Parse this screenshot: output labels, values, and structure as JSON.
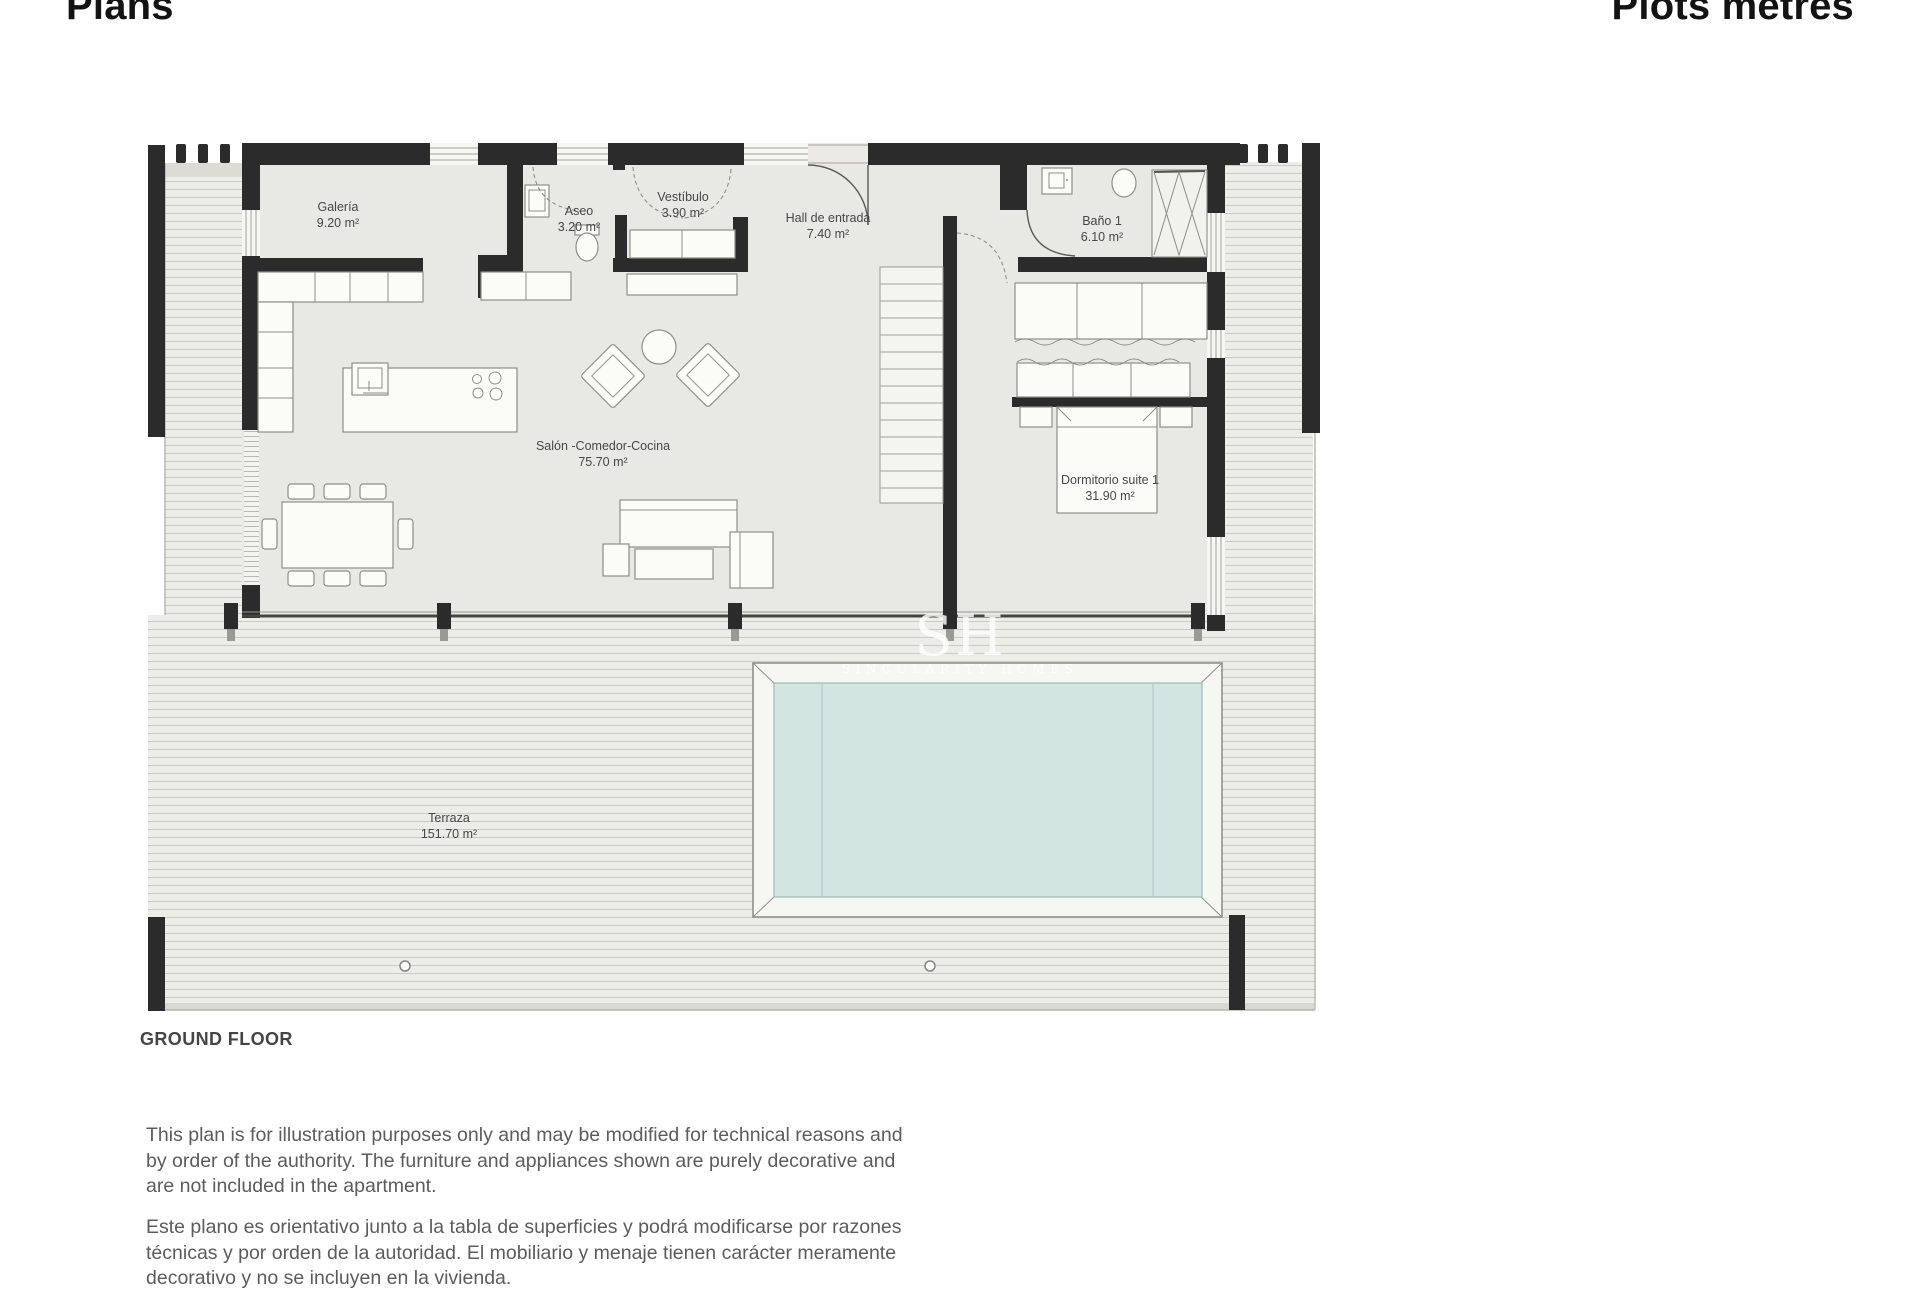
{
  "page": {
    "title_left": "Plans",
    "title_right": "Plots metres",
    "caption": "GROUND FLOOR",
    "disclaimer_en": {
      "lines": [
        "This plan is for illustration purposes only and may be modified for technical reasons and",
        "by order of the authority. The furniture and appliances shown are purely decorative and",
        "are not included in the apartment."
      ]
    },
    "disclaimer_es": {
      "lines": [
        "Este plano es orientativo junto a la tabla de superficies y podrá modificarse por razones",
        "técnicas y por orden de la autoridad. El mobiliario y menaje tienen carácter meramente",
        "decorativo y no se incluyen en la vivienda."
      ]
    }
  },
  "floor_plan": {
    "floor_name": "GROUND FLOOR",
    "rooms": [
      {
        "id": "galeria",
        "name": "Galería",
        "area": "9.20 m²"
      },
      {
        "id": "aseo",
        "name": "Aseo",
        "area": "3.20 m²"
      },
      {
        "id": "vestibulo",
        "name": "Vestíbulo",
        "area": "3.90 m²"
      },
      {
        "id": "hall",
        "name": "Hall de entrada",
        "area": "7.40 m²"
      },
      {
        "id": "bano1",
        "name": "Baño 1",
        "area": "6.10 m²"
      },
      {
        "id": "salon",
        "name": "Salón -Comedor-Cocina",
        "area": "75.70 m²"
      },
      {
        "id": "dormitorio",
        "name": "Dormitorio suite 1",
        "area": "31.90 m²"
      },
      {
        "id": "terraza",
        "name": "Terraza",
        "area": "151.70 m²"
      }
    ],
    "watermark": {
      "initials": "SH",
      "name": "SINGULARITY HOMES"
    },
    "colors": {
      "wall": "#2b2b2b",
      "interior": "#e8e8e5",
      "deck": "#ecece8",
      "deck_line": "#cbcbc3",
      "pool_water": "#d3e5e1",
      "pool_line": "#a9c0bc",
      "furniture_line": "#8f8f89",
      "label": "#474747"
    }
  }
}
